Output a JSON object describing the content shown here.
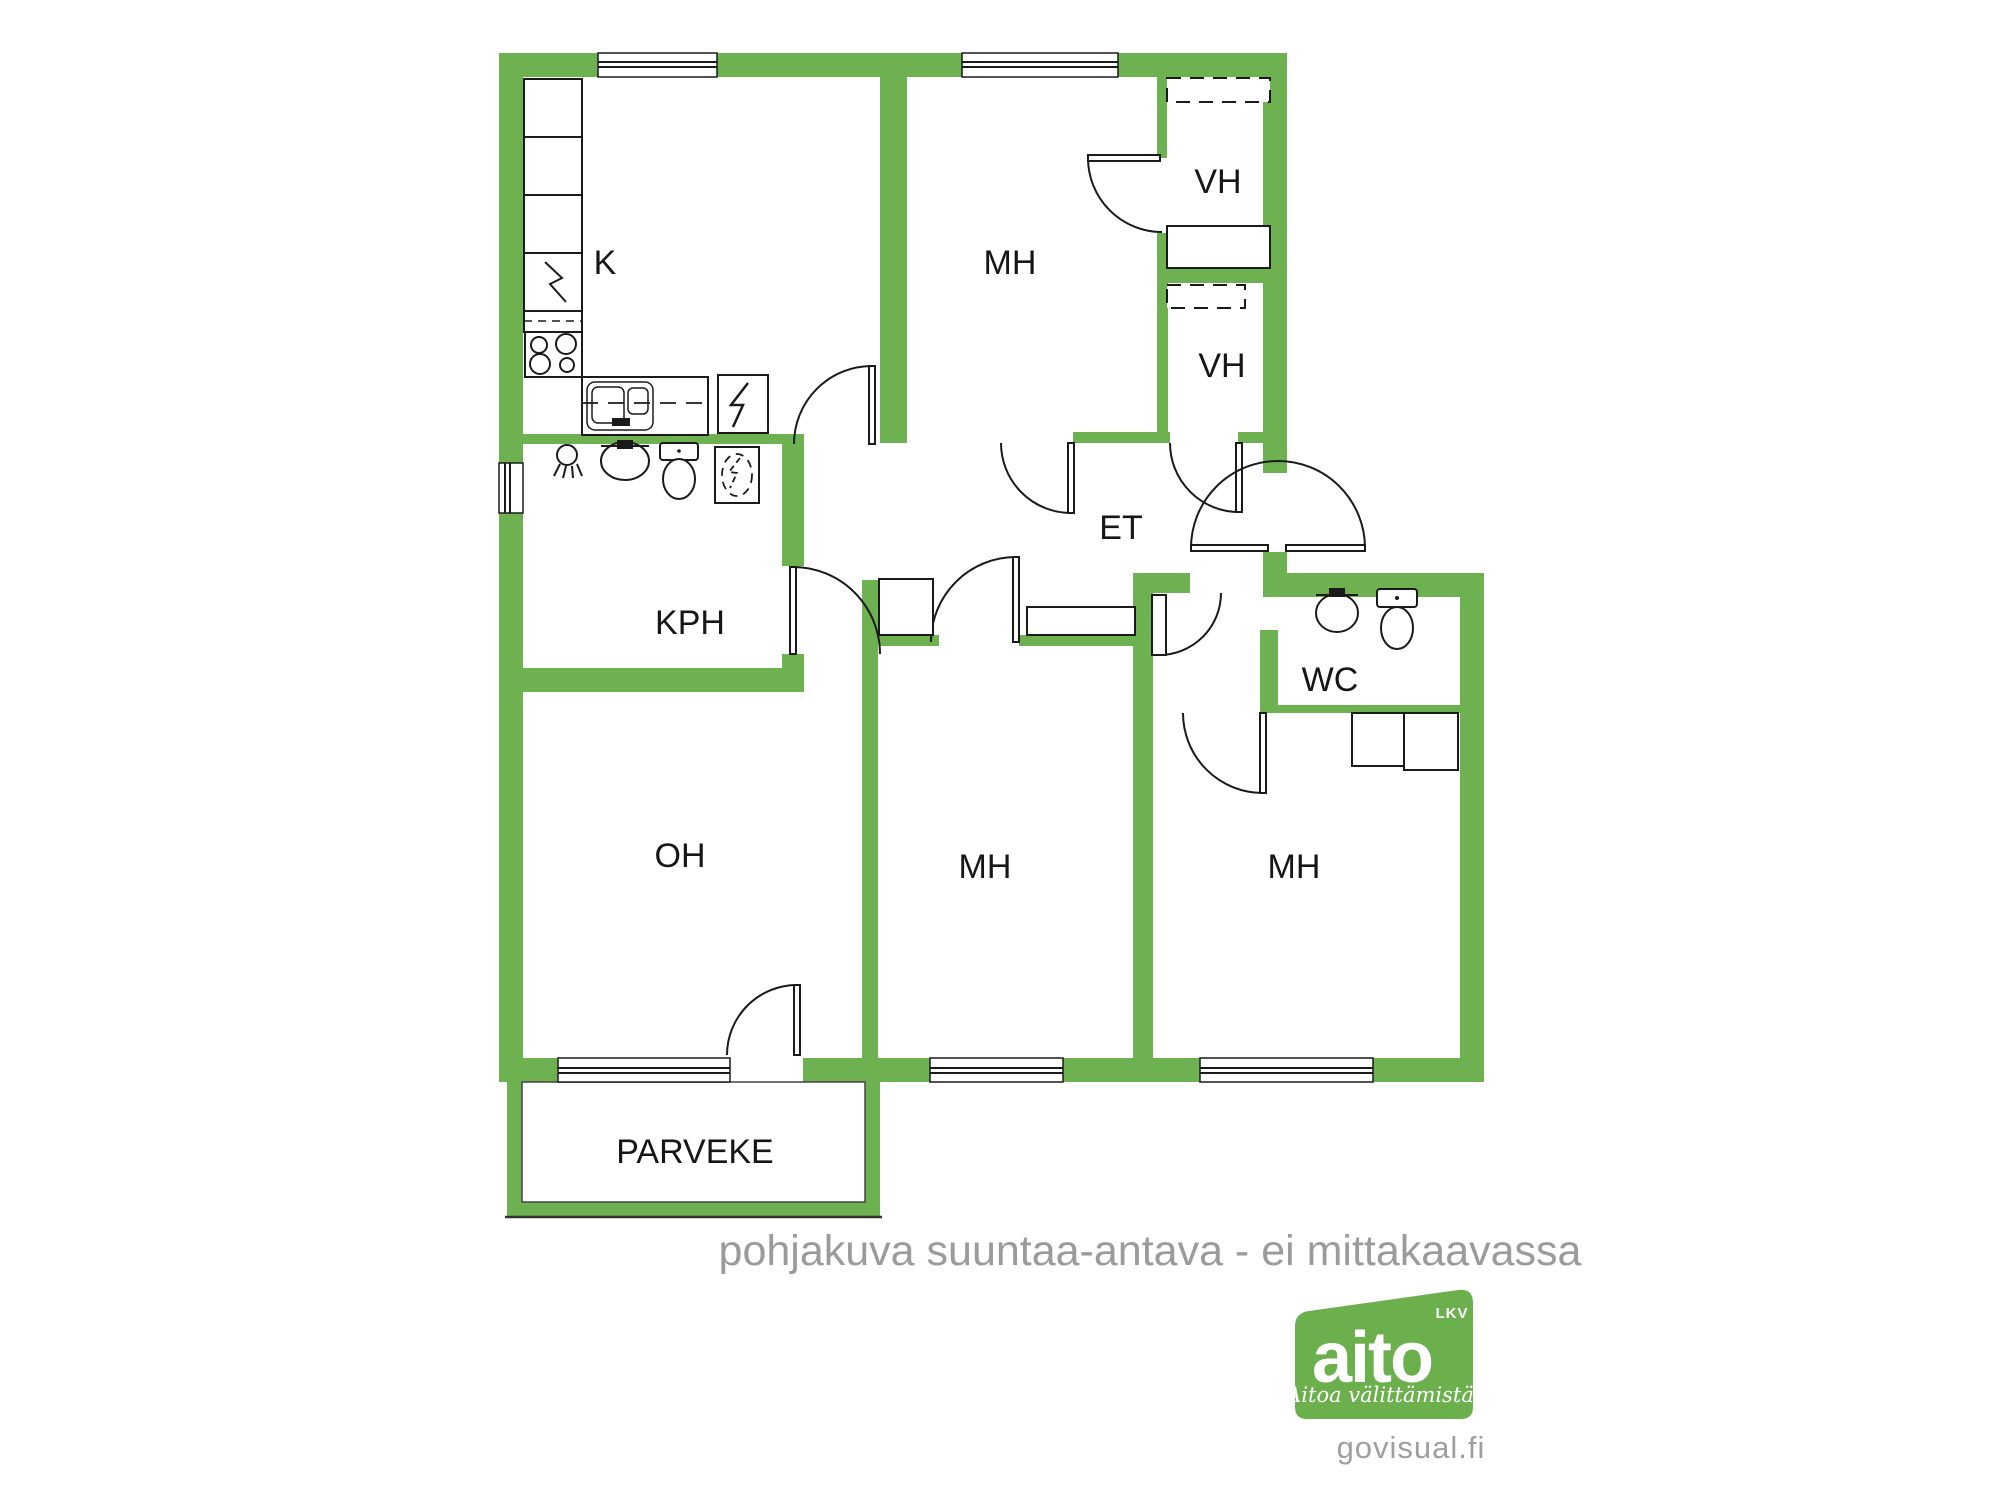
{
  "floorplan": {
    "wall_color": "#6DB150",
    "line_color": "#1a1a1a",
    "rooms": [
      {
        "id": "kitchen",
        "label": "K"
      },
      {
        "id": "bedroom-top",
        "label": "MH"
      },
      {
        "id": "closet-upper",
        "label": "VH"
      },
      {
        "id": "closet-lower",
        "label": "VH"
      },
      {
        "id": "hallway",
        "label": "ET"
      },
      {
        "id": "bathroom",
        "label": "KPH"
      },
      {
        "id": "toilet",
        "label": "WC"
      },
      {
        "id": "living-room",
        "label": "OH"
      },
      {
        "id": "bedroom-middle",
        "label": "MH"
      },
      {
        "id": "bedroom-right",
        "label": "MH"
      },
      {
        "id": "balcony",
        "label": "PARVEKE"
      }
    ],
    "icons": [
      "stove-icon",
      "kitchen-sink-icon",
      "electrical-panel-icon",
      "cabinet-icon",
      "shower-icon",
      "bathroom-sink-icon",
      "toilet-icon",
      "washing-machine-icon",
      "wardrobe-icon",
      "window-icon",
      "door-icon"
    ],
    "disclaimer": "pohjakuva suuntaa-antava - ei mittakaavassa"
  },
  "branding": {
    "logo_text": "aito",
    "logo_suffix": "LKV",
    "logo_tagline": "Aitoa välittämistä",
    "logo_color": "#6CB04E",
    "website": "govisual.fi"
  }
}
